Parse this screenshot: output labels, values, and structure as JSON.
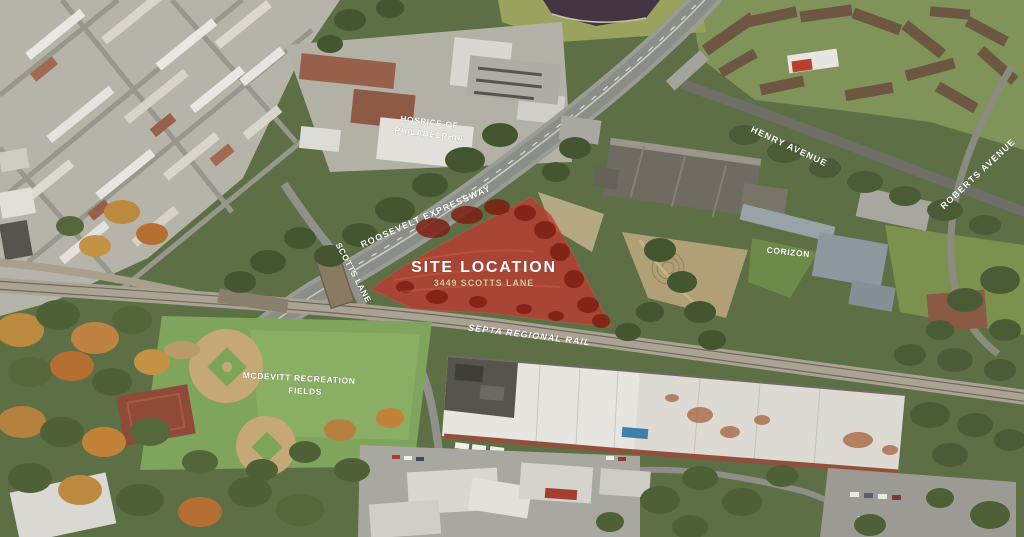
{
  "labels": {
    "site_title": "SITE LOCATION",
    "site_address": "3449 SCOTTS LANE",
    "roosevelt_expressway": "ROOSEVELT EXPRESSWAY",
    "henry_avenue": "HENRY AVENUE",
    "roberts_avenue": "ROBERTS AVENUE",
    "scotts_lane": "SCOTTS LANE",
    "septa_regional_rail": "SEPTA REGIONAL RAIL",
    "mcdevitt_line1": "MCDEVITT RECREATION",
    "mcdevitt_line2": "FIELDS",
    "hospice_line1": "HOSPICE OF",
    "hospice_line2": "PHILADELPHIA",
    "corizon": "CORIZON"
  },
  "colors": {
    "site_overlay_red": "#bf3a30",
    "site_overlay_dark_red": "#7d1f12",
    "label_white": "#ffffff",
    "address_tan": "#d6cc96"
  }
}
